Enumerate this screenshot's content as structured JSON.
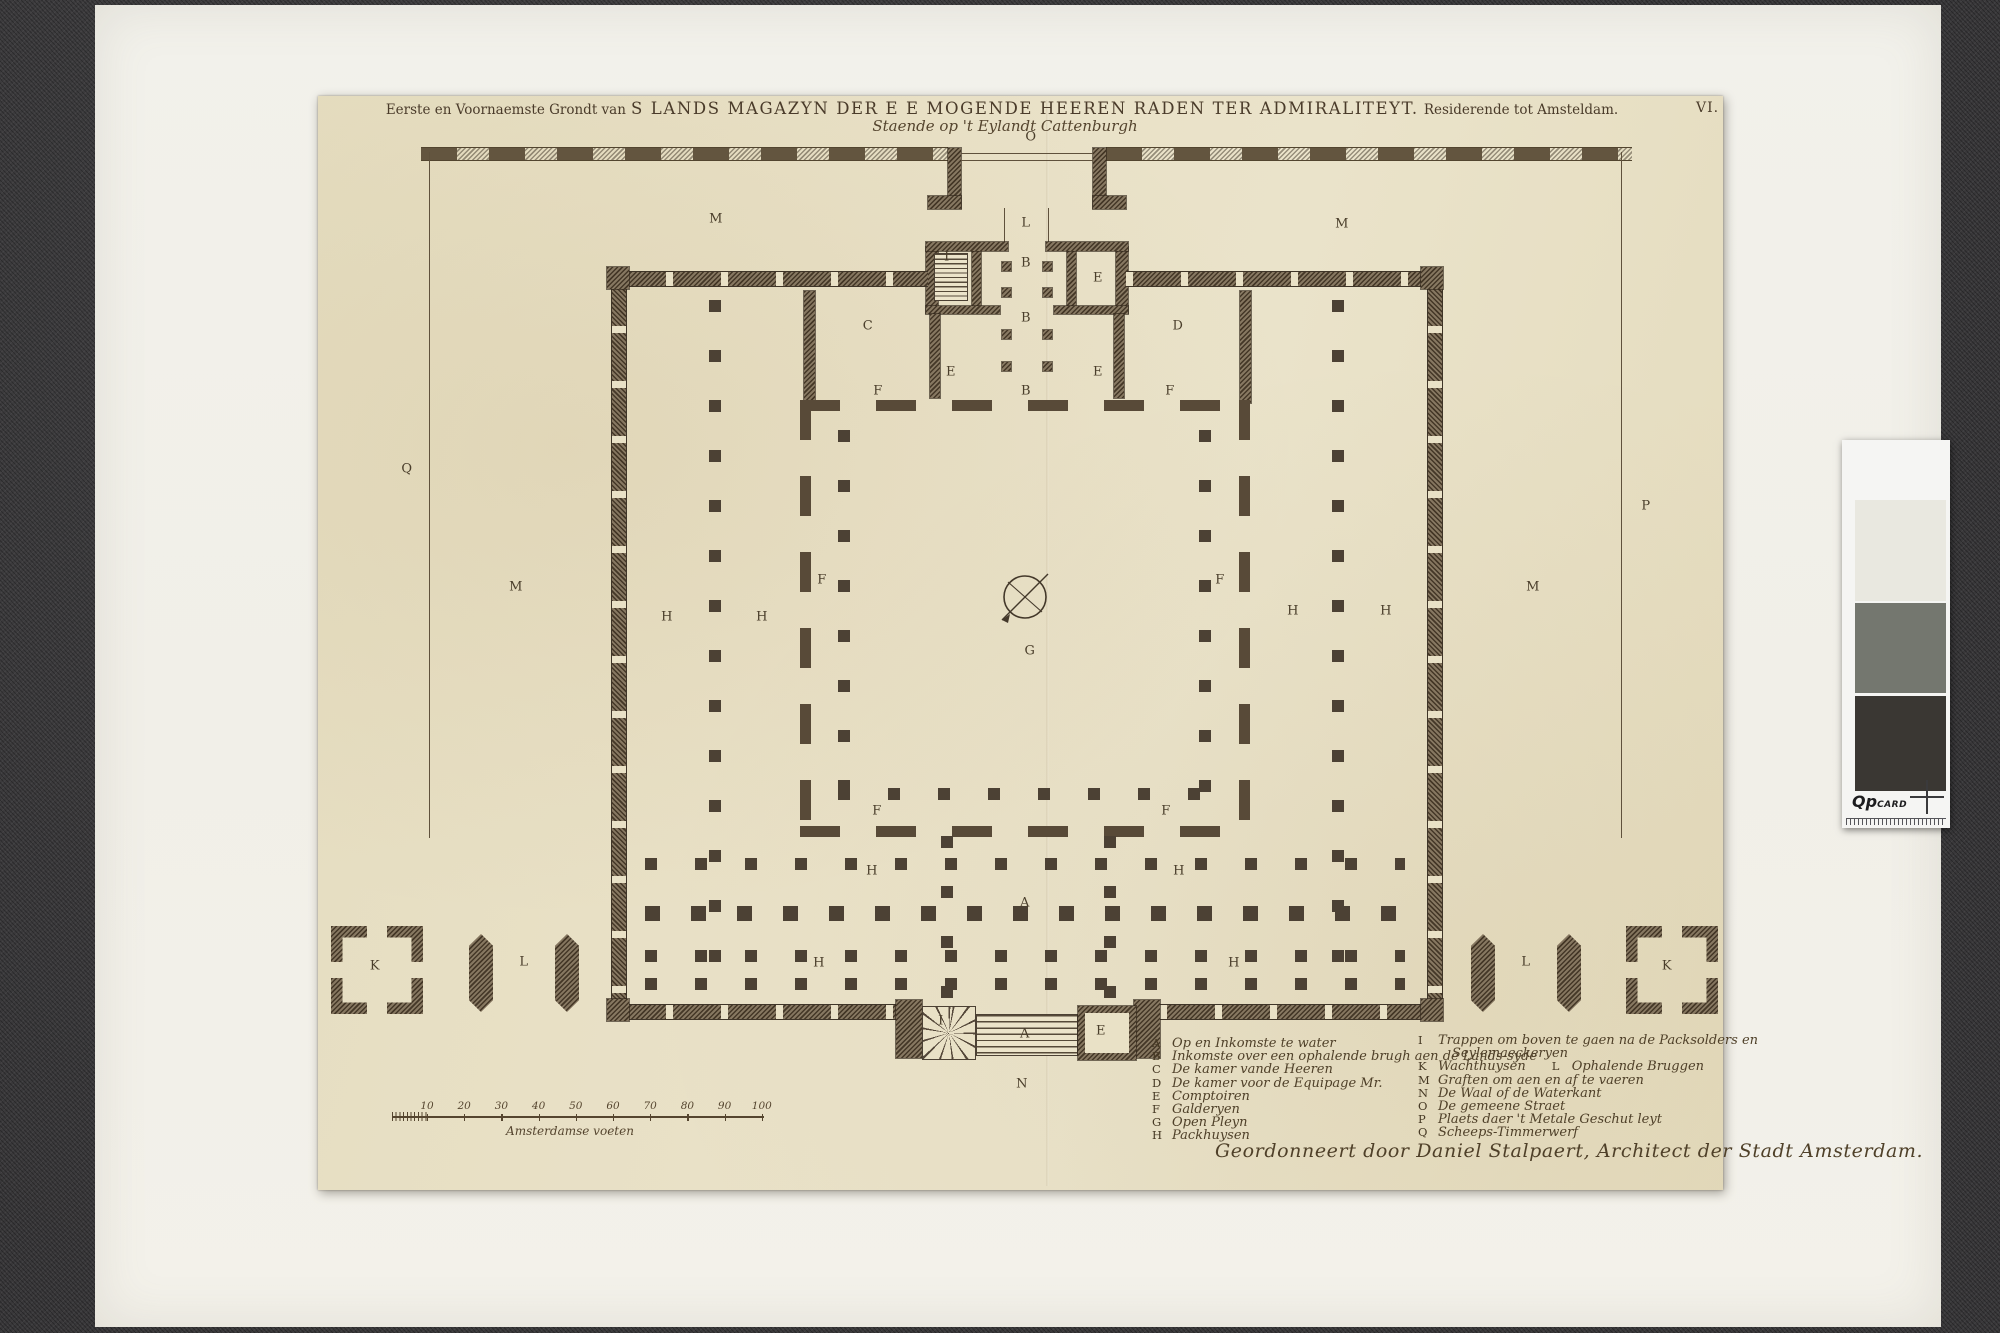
{
  "artwork": {
    "title_prefix": "Eerste en Voornaemste Grondt van",
    "title_main": "S LANDS MAGAZYN DER E E MOGENDE HEEREN RADEN TER ADMIRALITEYT.",
    "title_suffix": "Residerende tot Amsteldam.",
    "subtitle": "Staende op 't Eylandt Cattenburgh",
    "plate_number": "VI.",
    "signature": "Geordonneert door Daniel Stalpaert, Architect der Stadt Amsterdam."
  },
  "plan": {
    "letters": [
      {
        "ch": "O",
        "x": 1031,
        "y": 137
      },
      {
        "ch": "M",
        "x": 716,
        "y": 219
      },
      {
        "ch": "M",
        "x": 1342,
        "y": 224
      },
      {
        "ch": "L",
        "x": 1026,
        "y": 223
      },
      {
        "ch": "I",
        "x": 947,
        "y": 257
      },
      {
        "ch": "B",
        "x": 1026,
        "y": 263
      },
      {
        "ch": "E",
        "x": 1098,
        "y": 278
      },
      {
        "ch": "B",
        "x": 1026,
        "y": 318
      },
      {
        "ch": "C",
        "x": 868,
        "y": 326
      },
      {
        "ch": "D",
        "x": 1178,
        "y": 326
      },
      {
        "ch": "E",
        "x": 951,
        "y": 372
      },
      {
        "ch": "E",
        "x": 1098,
        "y": 372
      },
      {
        "ch": "F",
        "x": 878,
        "y": 391
      },
      {
        "ch": "B",
        "x": 1026,
        "y": 391
      },
      {
        "ch": "F",
        "x": 1170,
        "y": 391
      },
      {
        "ch": "Q",
        "x": 407,
        "y": 469
      },
      {
        "ch": "P",
        "x": 1646,
        "y": 506
      },
      {
        "ch": "F",
        "x": 822,
        "y": 580
      },
      {
        "ch": "F",
        "x": 1220,
        "y": 580
      },
      {
        "ch": "M",
        "x": 516,
        "y": 587
      },
      {
        "ch": "M",
        "x": 1533,
        "y": 587
      },
      {
        "ch": "H",
        "x": 667,
        "y": 617
      },
      {
        "ch": "H",
        "x": 762,
        "y": 617
      },
      {
        "ch": "H",
        "x": 1293,
        "y": 611
      },
      {
        "ch": "H",
        "x": 1386,
        "y": 611
      },
      {
        "ch": "G",
        "x": 1030,
        "y": 651
      },
      {
        "ch": "F",
        "x": 877,
        "y": 811
      },
      {
        "ch": "F",
        "x": 1166,
        "y": 811
      },
      {
        "ch": "H",
        "x": 872,
        "y": 871
      },
      {
        "ch": "H",
        "x": 1179,
        "y": 871
      },
      {
        "ch": "A",
        "x": 1025,
        "y": 903
      },
      {
        "ch": "H",
        "x": 819,
        "y": 963
      },
      {
        "ch": "H",
        "x": 1234,
        "y": 963
      },
      {
        "ch": "K",
        "x": 375,
        "y": 966
      },
      {
        "ch": "L",
        "x": 524,
        "y": 962
      },
      {
        "ch": "L",
        "x": 1526,
        "y": 962
      },
      {
        "ch": "K",
        "x": 1667,
        "y": 966
      },
      {
        "ch": "I",
        "x": 941,
        "y": 1021
      },
      {
        "ch": "A",
        "x": 1025,
        "y": 1034
      },
      {
        "ch": "E",
        "x": 1101,
        "y": 1031
      },
      {
        "ch": "N",
        "x": 1022,
        "y": 1084
      }
    ]
  },
  "legend": {
    "left": [
      [
        {
          "key": "A",
          "text": "Op en Inkomste te water"
        }
      ],
      [
        {
          "key": "B",
          "text": "Inkomste over een ophalende brugh aen de Lands-syde"
        }
      ],
      [
        {
          "key": "C",
          "text": "De kamer vande Heeren"
        }
      ],
      [
        {
          "key": "D",
          "text": "De kamer voor de Equipage Mr."
        }
      ],
      [
        {
          "key": "E",
          "text": "Comptoiren"
        }
      ],
      [
        {
          "key": "F",
          "text": "Galderyen"
        }
      ],
      [
        {
          "key": "G",
          "text": "Open Pleyn"
        }
      ],
      [
        {
          "key": "H",
          "text": "Packhuysen"
        }
      ]
    ],
    "right": [
      [
        {
          "key": "I",
          "text": "Trappen om boven te gaen na de Packsolders en"
        }
      ],
      [
        {
          "key": "",
          "text": "Seylemaeckeryen",
          "indent": true
        }
      ],
      [
        {
          "key": "K",
          "text": "Wachthuysen"
        },
        {
          "key": "L",
          "text": "Ophalende Bruggen"
        }
      ],
      [
        {
          "key": "M",
          "text": "Graften om aen en af te vaeren"
        }
      ],
      [
        {
          "key": "N",
          "text": "De Waal of de Waterkant"
        }
      ],
      [
        {
          "key": "O",
          "text": "De gemeene Straet"
        }
      ],
      [
        {
          "key": "P",
          "text": "Plaets daer 't Metale Geschut leyt"
        }
      ],
      [
        {
          "key": "Q",
          "text": "Scheeps-Timmerwerf"
        }
      ]
    ]
  },
  "scalebar": {
    "numbers": [
      "10",
      "20",
      "30",
      "40",
      "50",
      "60",
      "70",
      "80",
      "90",
      "100"
    ],
    "caption": "Amsterdamse voeten"
  },
  "qp_card": {
    "brand": "Qp",
    "brand_suffix": "CARD",
    "patches": [
      "#e9e8e0",
      "#74776f",
      "#3a3733"
    ]
  },
  "colors": {
    "backdrop": "#39383a",
    "mat": "#f1efe8",
    "paper": "#e8e0c5",
    "ink": "#43382a",
    "wall": "#6f5f49"
  }
}
